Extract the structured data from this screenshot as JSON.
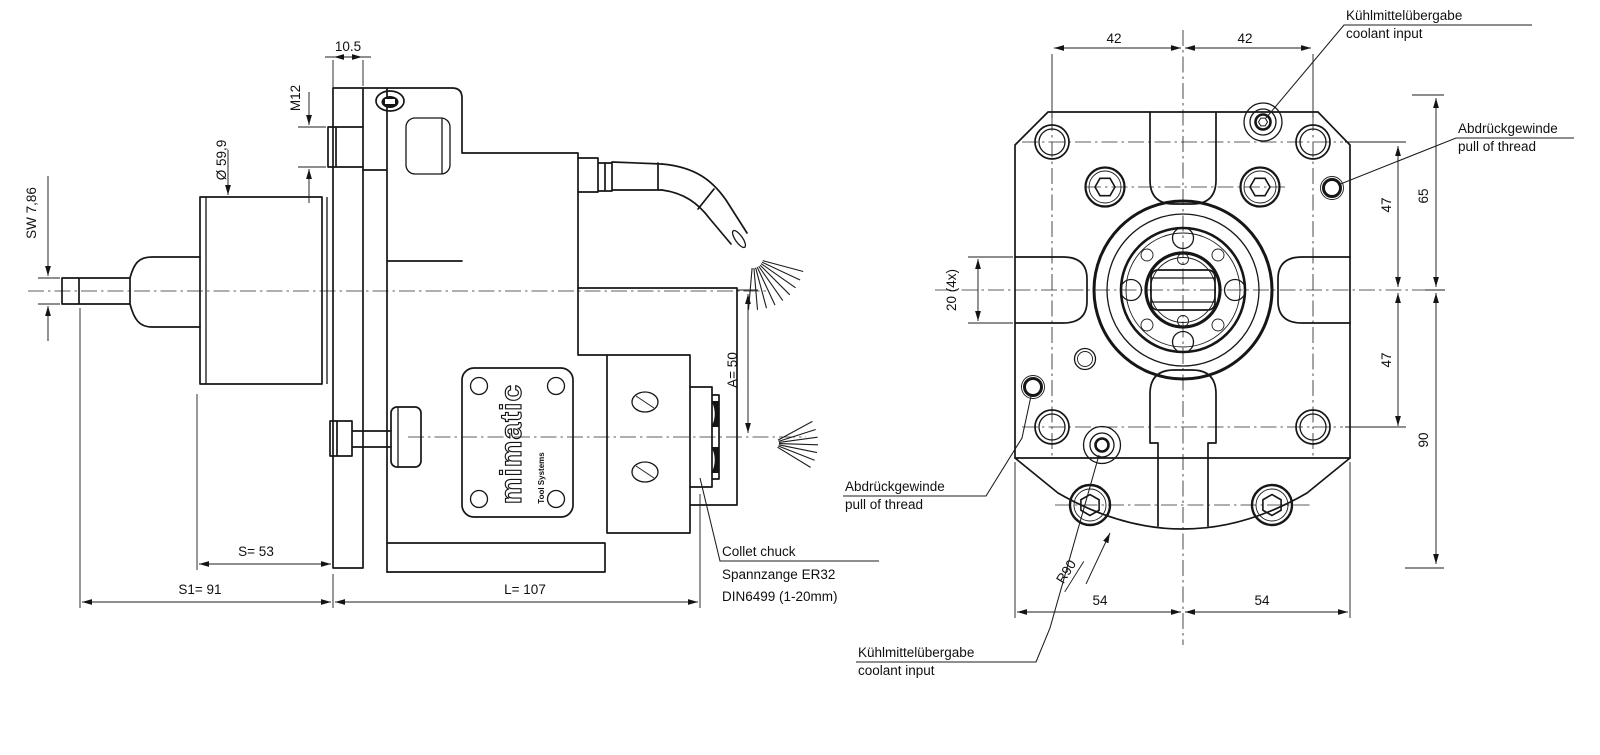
{
  "drawing": {
    "brand": {
      "name": "mimatic",
      "tagline": "Tool Systems"
    },
    "side_view": {
      "dim_sw": "SW  7,86",
      "dim_dia": "Ø 59,9",
      "dim_thickness": "10.5",
      "dim_thread": "M12",
      "dim_a": "A=  50",
      "dim_s": "S=   53",
      "dim_s1": "S1=   91",
      "dim_l": "L=   107",
      "collet_note_line1": "Collet chuck",
      "collet_note_line2": "Spannzange ER32",
      "collet_note_line3": "DIN6499 (1-20mm)"
    },
    "front_view": {
      "dim_42_left": "42",
      "dim_42_right": "42",
      "dim_47_upper": "47",
      "dim_47_lower": "47",
      "dim_65": "65",
      "dim_90": "90",
      "dim_54_left": "54",
      "dim_54_right": "54",
      "dim_slot": "20  (4x)",
      "dim_radius": "R90",
      "label_coolant_de": "Kühlmittelübergabe",
      "label_coolant_en": "coolant input",
      "label_pulloff_de": "Abdrückgewinde",
      "label_pulloff_en": "pull of thread"
    }
  }
}
